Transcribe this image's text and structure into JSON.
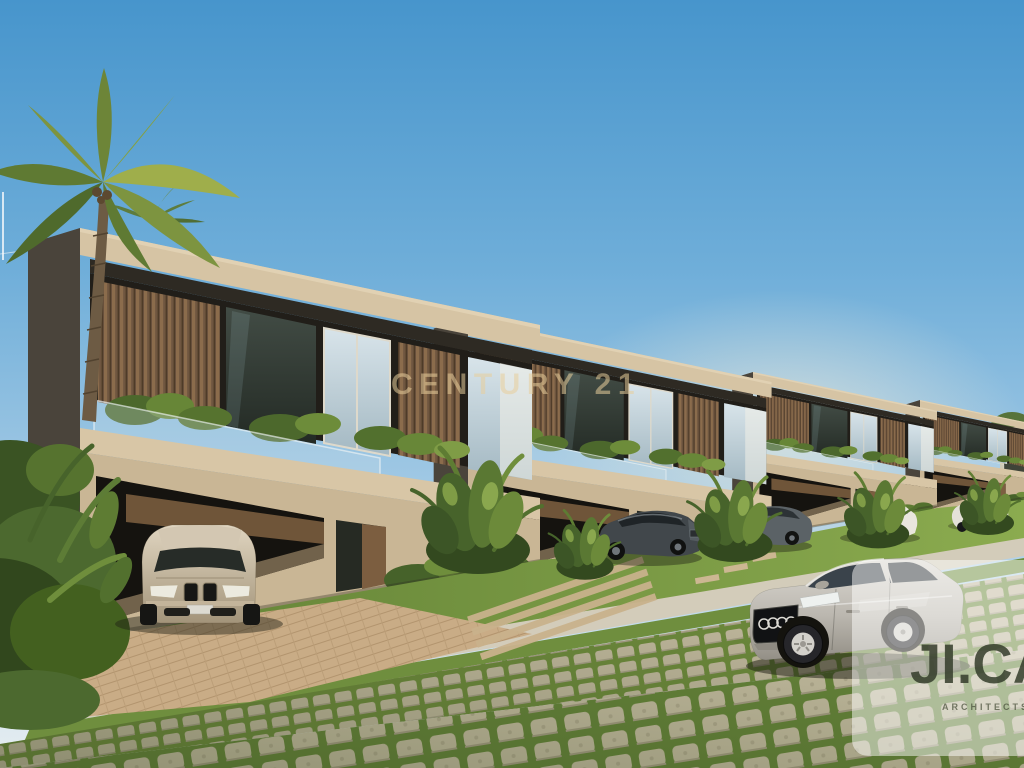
{
  "watermark": {
    "text": "CENTURY 21",
    "color": "#e7cd9b"
  },
  "logo_card": {
    "title": "JI.CA",
    "subtitle": "ARCHITECTS",
    "text_color": "#343c2a",
    "background": "rgba(253,253,251,0.5)"
  },
  "scene": {
    "subject": "row of modern two-storey tropical villas with carports and parked cars",
    "objects": [
      "palm-tree",
      "four-villas",
      "bmw-sedan-in-carport",
      "dark-sedan",
      "gray-sedan",
      "white-cars",
      "silver-audi-sedan",
      "lawn",
      "sidewalk",
      "brick-driveway",
      "grass-block-pavers",
      "tropical-plants",
      "blue-sky"
    ],
    "palette": {
      "sky_top": "#4795cc",
      "sky_horizon": "#e8eef1",
      "concrete_sunlit": "#d6c4a4",
      "concrete_shadow": "#8d7f6a",
      "wood_slats": "#6f5640",
      "foliage_dark": "#3c5526",
      "foliage_light": "#86a44b",
      "lawn": "#6f8e3e",
      "paver_stone": "#c2b99f",
      "brick_drive": "#c9ac86",
      "car_champagne": "#cfc3ae",
      "car_silver": "#b9b5ac",
      "car_dark": "#3e4447"
    }
  }
}
